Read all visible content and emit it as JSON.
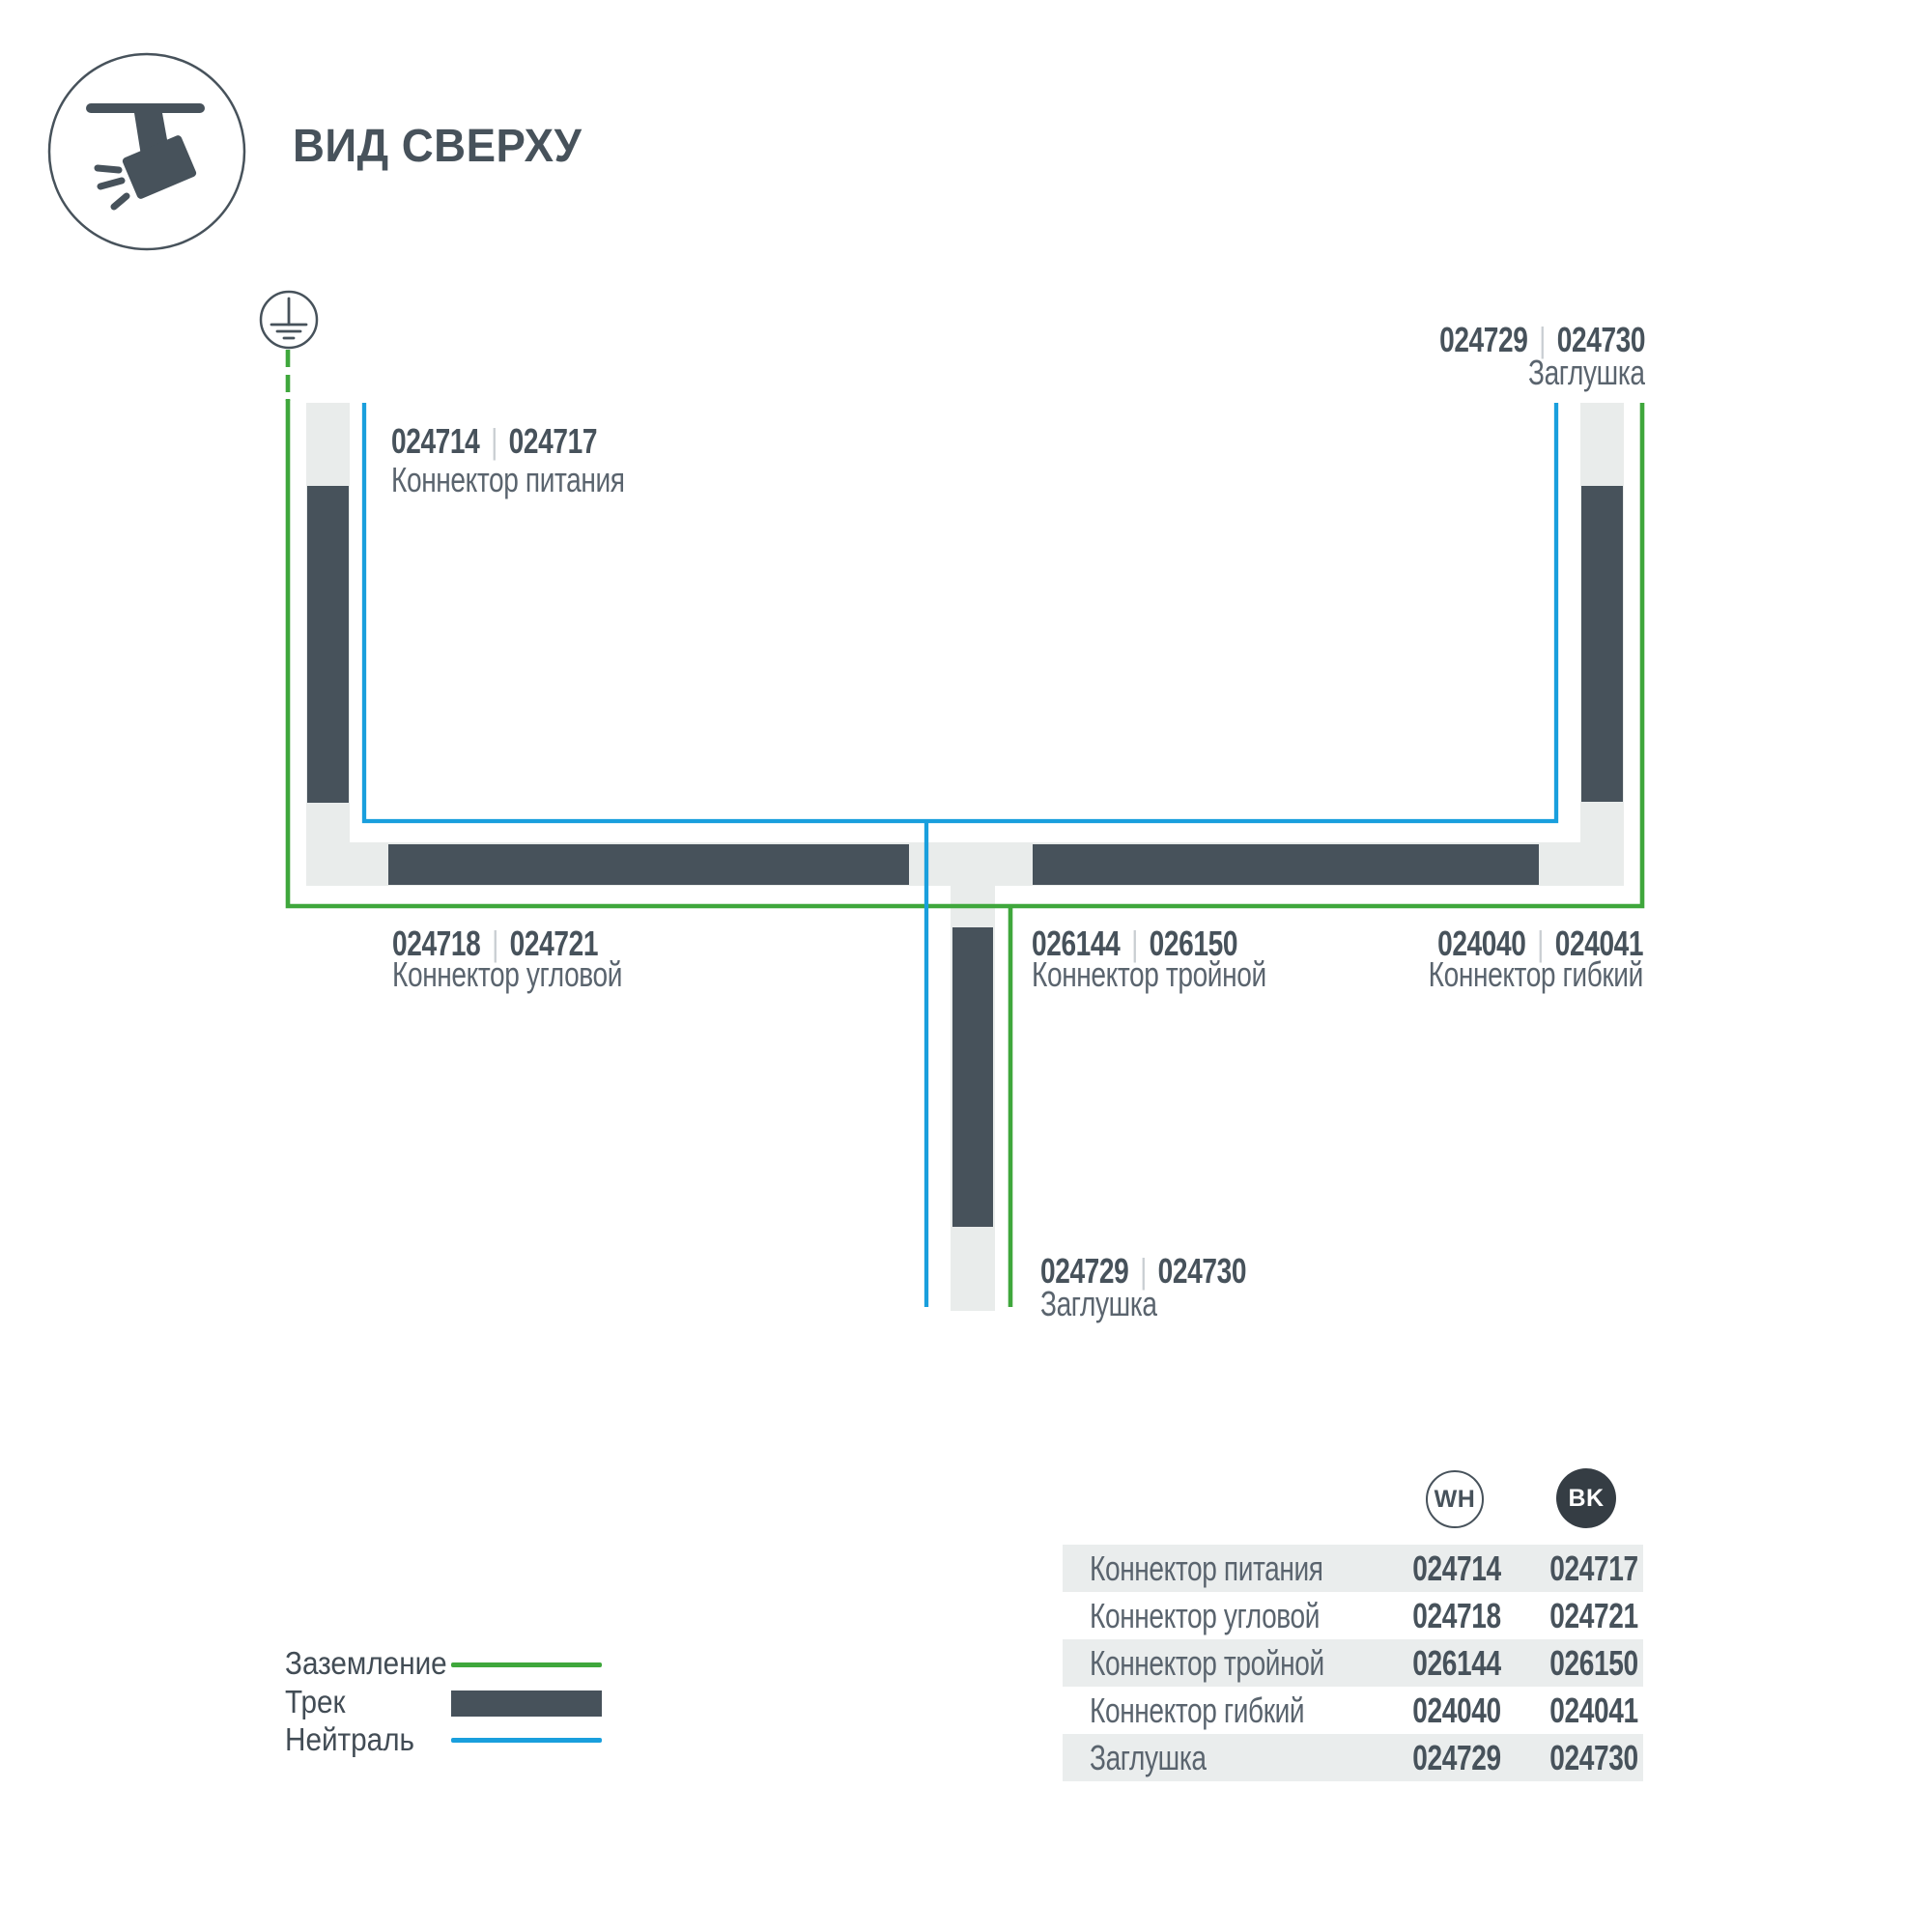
{
  "header": {
    "title": "ВИД СВЕРХУ"
  },
  "icons": {
    "header": "track-spotlight-icon",
    "ground": "ground-earth-icon"
  },
  "diagram": {
    "separator": "|",
    "labels": {
      "power": {
        "code_wh": "024714",
        "code_bk": "024717",
        "name": "Коннектор питания"
      },
      "endcap_top": {
        "code_wh": "024729",
        "code_bk": "024730",
        "name": "Заглушка"
      },
      "corner": {
        "code_wh": "024718",
        "code_bk": "024721",
        "name": "Коннектор угловой"
      },
      "triple": {
        "code_wh": "026144",
        "code_bk": "026150",
        "name": "Коннектор тройной"
      },
      "flex": {
        "code_wh": "024040",
        "code_bk": "024041",
        "name": "Коннектор гибкий"
      },
      "endcap_bottom": {
        "code_wh": "024729",
        "code_bk": "024730",
        "name": "Заглушка"
      }
    }
  },
  "legend": {
    "items": [
      {
        "label": "Заземление",
        "type": "ground-line"
      },
      {
        "label": "Трек",
        "type": "track-bar"
      },
      {
        "label": "Нейтраль",
        "type": "neutral-line"
      }
    ]
  },
  "table": {
    "col_wh": "WH",
    "col_bk": "BK",
    "rows": [
      {
        "name": "Коннектор питания",
        "wh": "024714",
        "bk": "024717"
      },
      {
        "name": "Коннектор угловой",
        "wh": "024718",
        "bk": "024721"
      },
      {
        "name": "Коннектор тройной",
        "wh": "026144",
        "bk": "026150"
      },
      {
        "name": "Коннектор гибкий",
        "wh": "024040",
        "bk": "024041"
      },
      {
        "name": "Заглушка",
        "wh": "024729",
        "bk": "024730"
      }
    ]
  },
  "colors": {
    "dark": "#47525b",
    "name-gray": "#5a646e",
    "green": "#3fa73c",
    "blue": "#199fdd",
    "track-light": "#e9eceb",
    "stripe": "#eaeded",
    "sep": "#c9ced2",
    "bk-circle": "#353d44",
    "legend-text": "#424c55"
  }
}
